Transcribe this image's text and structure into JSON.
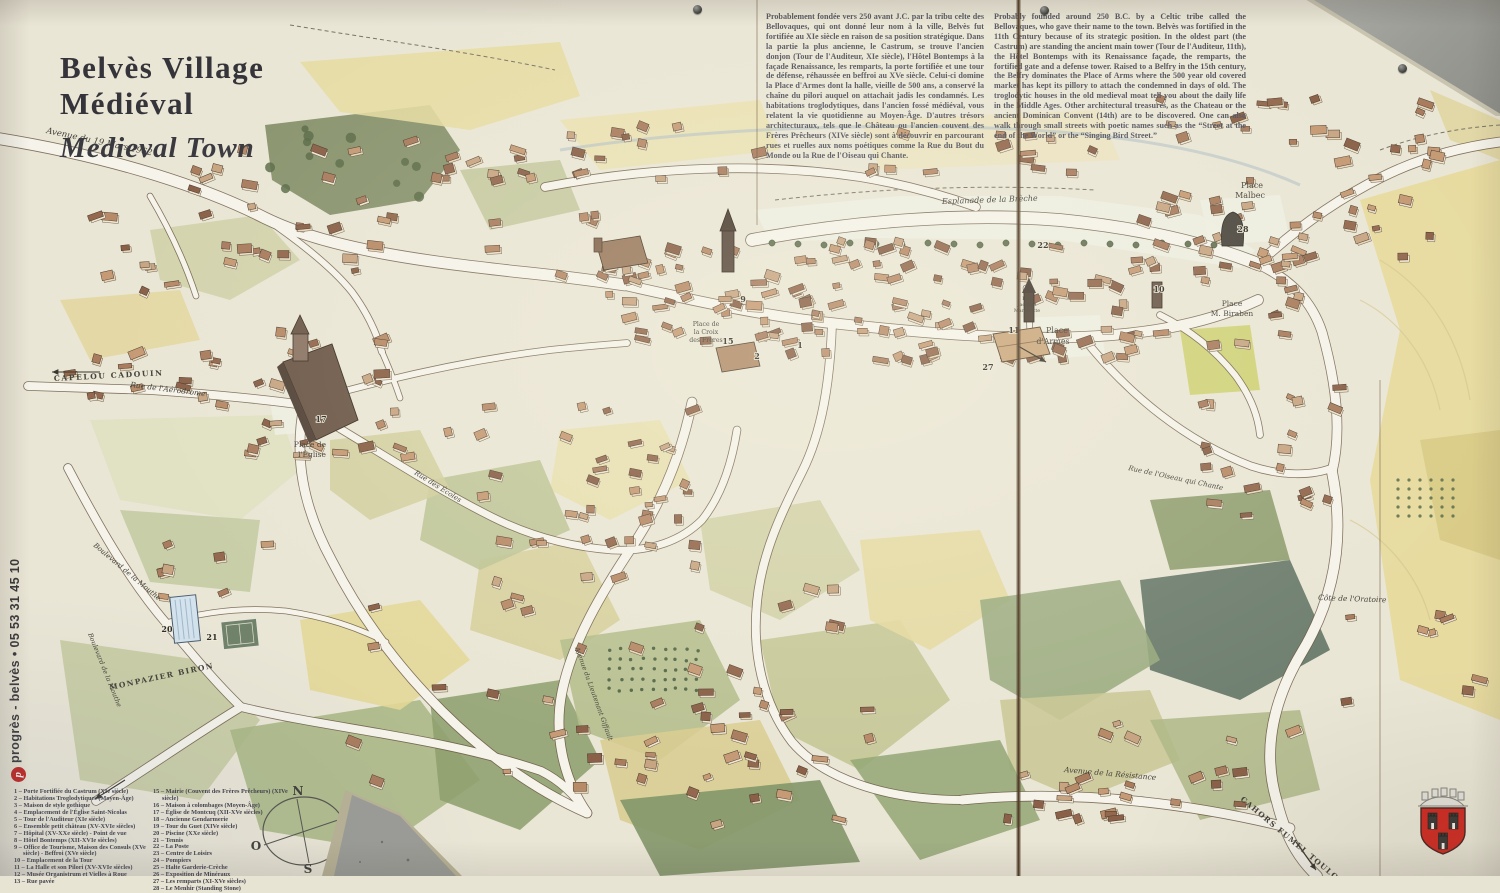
{
  "panel": {
    "title_line1": "Belvès Village",
    "title_line2": "Médiéval",
    "title_en": "Medieval Town"
  },
  "intro": {
    "fr": "Probablement fondée vers 250 avant J.C. par la tribu celte des Bellovaques, qui ont donné leur nom à la ville, Belvès fut fortifiée au XIe siècle en raison de sa position stratégique. Dans la partie la plus ancienne, le Castrum, se trouve l'ancien donjon (Tour de l'Auditeur, XIe siècle), l'Hôtel Bontemps à la façade Renaissance, les remparts, la porte fortifiée et une tour de défense, réhaussée en beffroi au XVe siècle. Celui-ci domine la Place d'Armes dont la halle, vieille de 500 ans, a conservé la chaîne du pilori auquel on attachait jadis les condamnés. Les habitations troglodytiques, dans l'ancien fossé médiéval, vous relatent la vie quotidienne au Moyen-Âge. D'autres trésors architecturaux, tels que le Château ou l'ancien couvent des Frères Prêcheurs (XIVe siècle) sont à découvrir en parcourant rues et ruelles aux noms poétiques comme la Rue du Bout du Monde ou la Rue de l'Oiseau qui Chante.",
    "en": "Probably founded around 250 B.C. by a Celtic tribe called the Bellovaques, who gave their name to the town. Belvès was fortified in the 11th Century because of its strategic position. In the oldest part (the Castrum) are standing the ancient main tower (Tour de l'Auditeur, 11th), the Hôtel Bontemps with its Renaissance façade, the remparts, the fortified gate and a defense tower. Raised to a Belfry in the 15th century, the Belfry dominates the Place of Arms where the 500 year old covered market has kept its pillory to attach the condemned in days of old. The troglodytic houses in the old medieval moat tell you about the daily life in the Middle Ages. Other architectural treasures, as the Chateau or the ancient Dominican Convent (14th) are to be discovered. One can also walk through small streets with poetic names such as the “Street at the end of the World” or the “Singing Bird Street.”"
  },
  "credit": {
    "logo": "p",
    "text": "progrès - belvès • 05 53 31 45 10"
  },
  "legend": {
    "col1": [
      "1 – Porte Fortifiée du Castrum (XIe siècle)",
      "2 – Habitations Troglodytiques (Moyen-Âge)",
      "3 – Maison de style gothique",
      "4 – Emplacement de l'Église Saint-Nicolas",
      "5 – Tour de l'Auditeur (XIe siècle)",
      "6 – Ensemble petit château (XV-XVIe siècles)",
      "7 – Hôpital (XV-XXe siècle) - Point de vue",
      "8 – Hôtel Bontemps (XII-XVIe siècles)",
      "9 – Office de Tourisme, Maison des Consuls (XVe siècle) - Beffroi (XVe siècle)",
      "10 – Emplacement de la Tour",
      "11 – La Halle et son Pilori (XV-XVIe siècles)",
      "12 – Musée Organistrum et Vielles à Roue",
      "13 – Rue pavée"
    ],
    "col2": [
      "15 – Mairie (Couvent des Frères Prêcheurs) (XIVe siècle)",
      "16 – Maison à colombages (Moyen-Âge)",
      "17 – Église de Montcuq (XII-XVe siècles)",
      "18 – Ancienne Gendarmerie",
      "19 – Tour du Guet (XIVe siècle)",
      "20 – Piscine (XXe siècle)",
      "21 – Tennis",
      "22 – La Poste",
      "23 – Centre de Loisirs",
      "24 – Pompiers",
      "25 – Halte Garderie-Crèche",
      "26 – Exposition de Minéraux",
      "27 – Les remparts (XI-XVe siècles)",
      "28 – Le Menhir (Standing Stone)"
    ]
  },
  "compass": {
    "n": "N",
    "e": "E",
    "s": "S",
    "o": "O"
  },
  "map": {
    "labels": [
      {
        "t": "Avenue du 19 Mars 1962",
        "x": 46,
        "y": 133,
        "r": 12,
        "s": 8.5,
        "it": 1
      },
      {
        "t": "CAPELOU  CADOUIN",
        "x": 54,
        "y": 381,
        "r": -3,
        "s": 7.5,
        "sp": 1.6,
        "b": 1
      },
      {
        "t": "Rue de l'Aérodrome",
        "x": 130,
        "y": 387,
        "r": 7,
        "s": 7.5,
        "it": 1
      },
      {
        "t": "Boulevard de la Mouthe",
        "x": 93,
        "y": 546,
        "r": 40,
        "s": 7,
        "it": 1
      },
      {
        "t": "Boulevard de la Mouthe",
        "x": 88,
        "y": 634,
        "r": 68,
        "s": 6.5,
        "it": 1
      },
      {
        "t": "MONPAZIER  BIRON",
        "x": 110,
        "y": 690,
        "r": -12,
        "s": 7.5,
        "sp": 1.4,
        "b": 1
      },
      {
        "t": "Esplanade de la Brèche",
        "x": 942,
        "y": 204,
        "r": -2,
        "s": 8,
        "it": 1
      },
      {
        "t": "Place",
        "x": 1252,
        "y": 188,
        "s": 8,
        "a": "middle"
      },
      {
        "t": "Malbec",
        "x": 1250,
        "y": 198,
        "s": 8,
        "a": "middle"
      },
      {
        "t": "Place",
        "x": 1057,
        "y": 333,
        "s": 8,
        "a": "middle"
      },
      {
        "t": "d'Armes",
        "x": 1053,
        "y": 344,
        "s": 8,
        "a": "middle"
      },
      {
        "t": "Place",
        "x": 1232,
        "y": 306,
        "s": 7.5,
        "a": "middle"
      },
      {
        "t": "M. Biraben",
        "x": 1232,
        "y": 316,
        "s": 7.5,
        "a": "middle"
      },
      {
        "t": "Rue",
        "x": 1027,
        "y": 300,
        "s": 4.8,
        "a": "middle"
      },
      {
        "t": "Jacques",
        "x": 1027,
        "y": 306,
        "s": 4.8,
        "a": "middle"
      },
      {
        "t": "Manchotte",
        "x": 1027,
        "y": 312,
        "s": 4.8,
        "a": "middle"
      },
      {
        "t": "Place de",
        "x": 310,
        "y": 447,
        "s": 7.5,
        "a": "middle"
      },
      {
        "t": "l'Église",
        "x": 312,
        "y": 457,
        "s": 7.5,
        "a": "middle"
      },
      {
        "t": "Rue des Écoles",
        "x": 414,
        "y": 474,
        "r": 32,
        "s": 7,
        "it": 1
      },
      {
        "t": "Place de",
        "x": 706,
        "y": 326,
        "s": 6.2,
        "a": "middle"
      },
      {
        "t": "la Croix",
        "x": 706,
        "y": 334,
        "s": 6.2,
        "a": "middle"
      },
      {
        "t": "des Frères",
        "x": 706,
        "y": 342,
        "s": 6.2,
        "a": "middle"
      },
      {
        "t": "Rue de l'Oiseau qui Chante",
        "x": 1128,
        "y": 470,
        "r": 12,
        "s": 7,
        "it": 1
      },
      {
        "t": "Côte de l'Oratoire",
        "x": 1318,
        "y": 600,
        "r": 2,
        "s": 7.5,
        "it": 1
      },
      {
        "t": "Avenue de la Résistance",
        "x": 1064,
        "y": 772,
        "r": 5,
        "s": 7.5,
        "it": 1
      },
      {
        "t": "CAHORS  FUMEL  TOULOUSE",
        "x": 1240,
        "y": 800,
        "r": 40,
        "s": 7.5,
        "sp": 1.2,
        "b": 1
      },
      {
        "t": "Avenue du Lieutenant Giffault",
        "x": 575,
        "y": 648,
        "r": 70,
        "s": 6.5,
        "it": 1
      }
    ],
    "markers": [
      {
        "n": "1",
        "x": 800,
        "y": 348
      },
      {
        "n": "2",
        "x": 757,
        "y": 359
      },
      {
        "n": "9",
        "x": 743,
        "y": 302
      },
      {
        "n": "15",
        "x": 728,
        "y": 344
      },
      {
        "n": "17",
        "x": 321,
        "y": 422
      },
      {
        "n": "10",
        "x": 1159,
        "y": 292
      },
      {
        "n": "11",
        "x": 1014,
        "y": 333
      },
      {
        "n": "22",
        "x": 1043,
        "y": 248
      },
      {
        "n": "20",
        "x": 167,
        "y": 632
      },
      {
        "n": "21",
        "x": 212,
        "y": 640
      },
      {
        "n": "27",
        "x": 988,
        "y": 370
      },
      {
        "n": "28",
        "x": 1243,
        "y": 232
      }
    ]
  },
  "colors": {
    "paper": "#e8e4d4",
    "road_fill": "#f5f3ea",
    "road_casing": "#6d5c48",
    "shield_red": "#cf2b22",
    "seam_brown": "#4d3a27",
    "logo_red": "#c22622"
  }
}
